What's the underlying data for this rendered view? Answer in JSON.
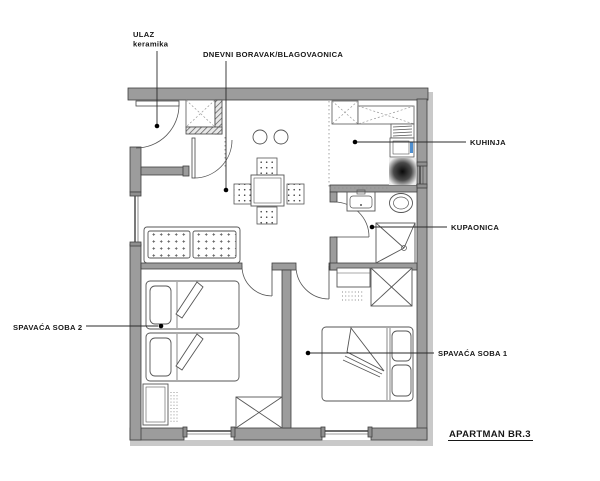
{
  "floorplan": {
    "title": "APARTMAN BR.3",
    "rooms": [
      {
        "id": "entrance",
        "label": "ULAZ",
        "sublabel": "keramika"
      },
      {
        "id": "living",
        "label": "DNEVNI BORAVAK/BLAGOVAONICA"
      },
      {
        "id": "kitchen",
        "label": "KUHINJA"
      },
      {
        "id": "bathroom",
        "label": "KUPAONICA"
      },
      {
        "id": "bedroom2",
        "label": "SPAVAĆA SOBA 2"
      },
      {
        "id": "bedroom1",
        "label": "SPAVAĆA SOBA 1"
      }
    ],
    "colors": {
      "wall": "#9c9c9c",
      "wall_outline": "#3f3f3f",
      "exterior_band": "#c9c9c9",
      "furniture_line": "#444444",
      "leader_line": "#2b2b2b",
      "accent_blue": "#4f8fd0",
      "stove_center": "#0a0a0a",
      "background": "#ffffff"
    }
  }
}
